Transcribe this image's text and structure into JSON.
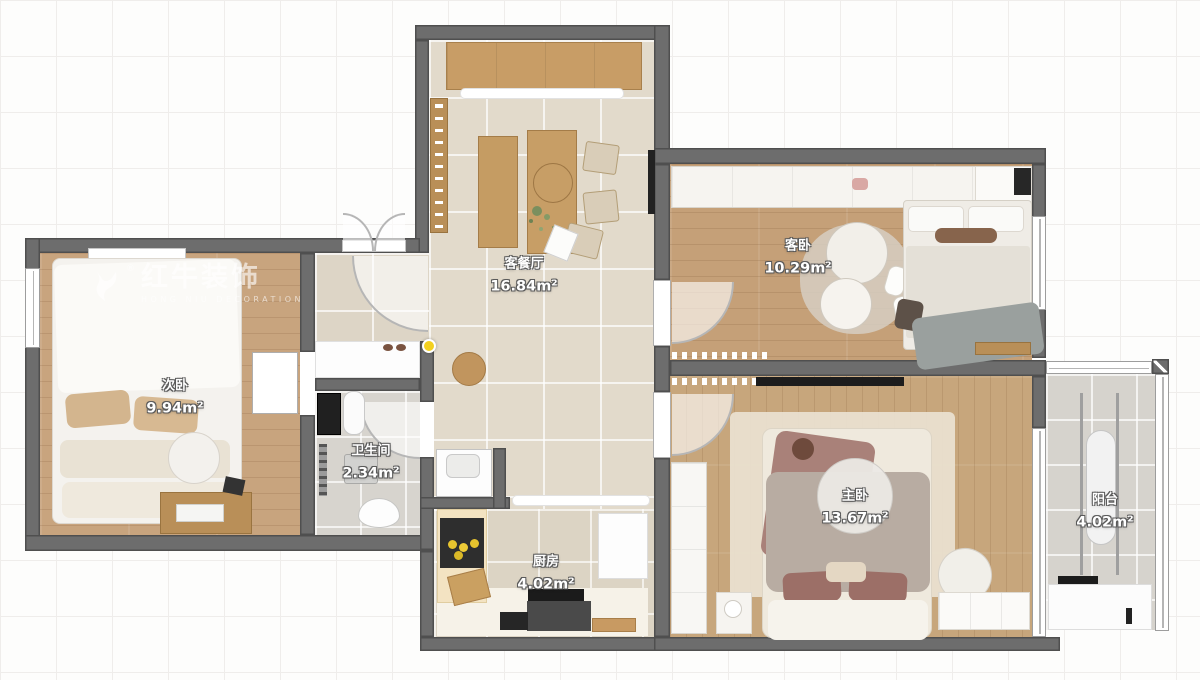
{
  "watermark": {
    "brand": "红牛装饰",
    "subtitle": "HONG NIU DECORATION",
    "reg": "®"
  },
  "rooms": [
    {
      "key": "living",
      "name": "客餐厅",
      "area": "16.84m²"
    },
    {
      "key": "guest",
      "name": "客卧",
      "area": "10.29m²"
    },
    {
      "key": "second",
      "name": "次卧",
      "area": "9.94m²"
    },
    {
      "key": "bath",
      "name": "卫生间",
      "area": "2.34m²"
    },
    {
      "key": "kitchen",
      "name": "厨房",
      "area": "4.02m²"
    },
    {
      "key": "master",
      "name": "主卧",
      "area": "13.67m²"
    },
    {
      "key": "balcony",
      "name": "阳台",
      "area": "4.02m²"
    }
  ],
  "colors": {
    "wall": "#6d6d6d",
    "wood": "#c5a078",
    "tile": "#e2dacb",
    "marker": "#f3d01e"
  }
}
